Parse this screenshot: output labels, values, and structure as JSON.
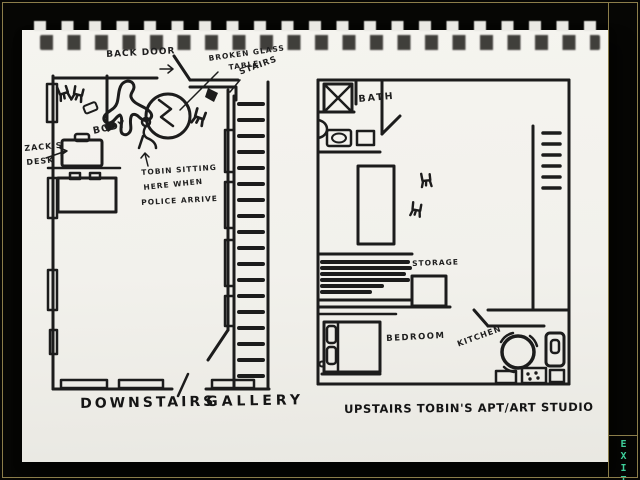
{
  "exit_button": {
    "label": "EXIT"
  },
  "colors": {
    "accent_green": "#3ECF9A",
    "pinstripe_khaki": "#8B7D4A",
    "ink": "#1C1C1C",
    "paper": "#F2F1EC"
  },
  "sketch": {
    "downstairs": {
      "back_door_label": "BACK DOOR",
      "broken_glass_label_line1": "BROKEN GLASS",
      "broken_glass_label_line2": "TABLE",
      "stairs_label": "STAIRS",
      "zacks_desk_label_line1": "ZACK'S",
      "zacks_desk_label_line2": "DESK",
      "body_label": "BODY",
      "tobin_note_line1": "TOBIN SITTING",
      "tobin_note_line2": "HERE WHEN",
      "tobin_note_line3": "POLICE ARRIVE",
      "caption_word1": "DOWNSTAIRS",
      "caption_word2": "GALLERY"
    },
    "upstairs": {
      "bath_label": "BATH",
      "storage_label": "STORAGE",
      "bedroom_label": "BEDROOM",
      "kitchen_label": "KITCHEN",
      "caption": "UPSTAIRS TOBIN'S APT/ART STUDIO"
    }
  }
}
